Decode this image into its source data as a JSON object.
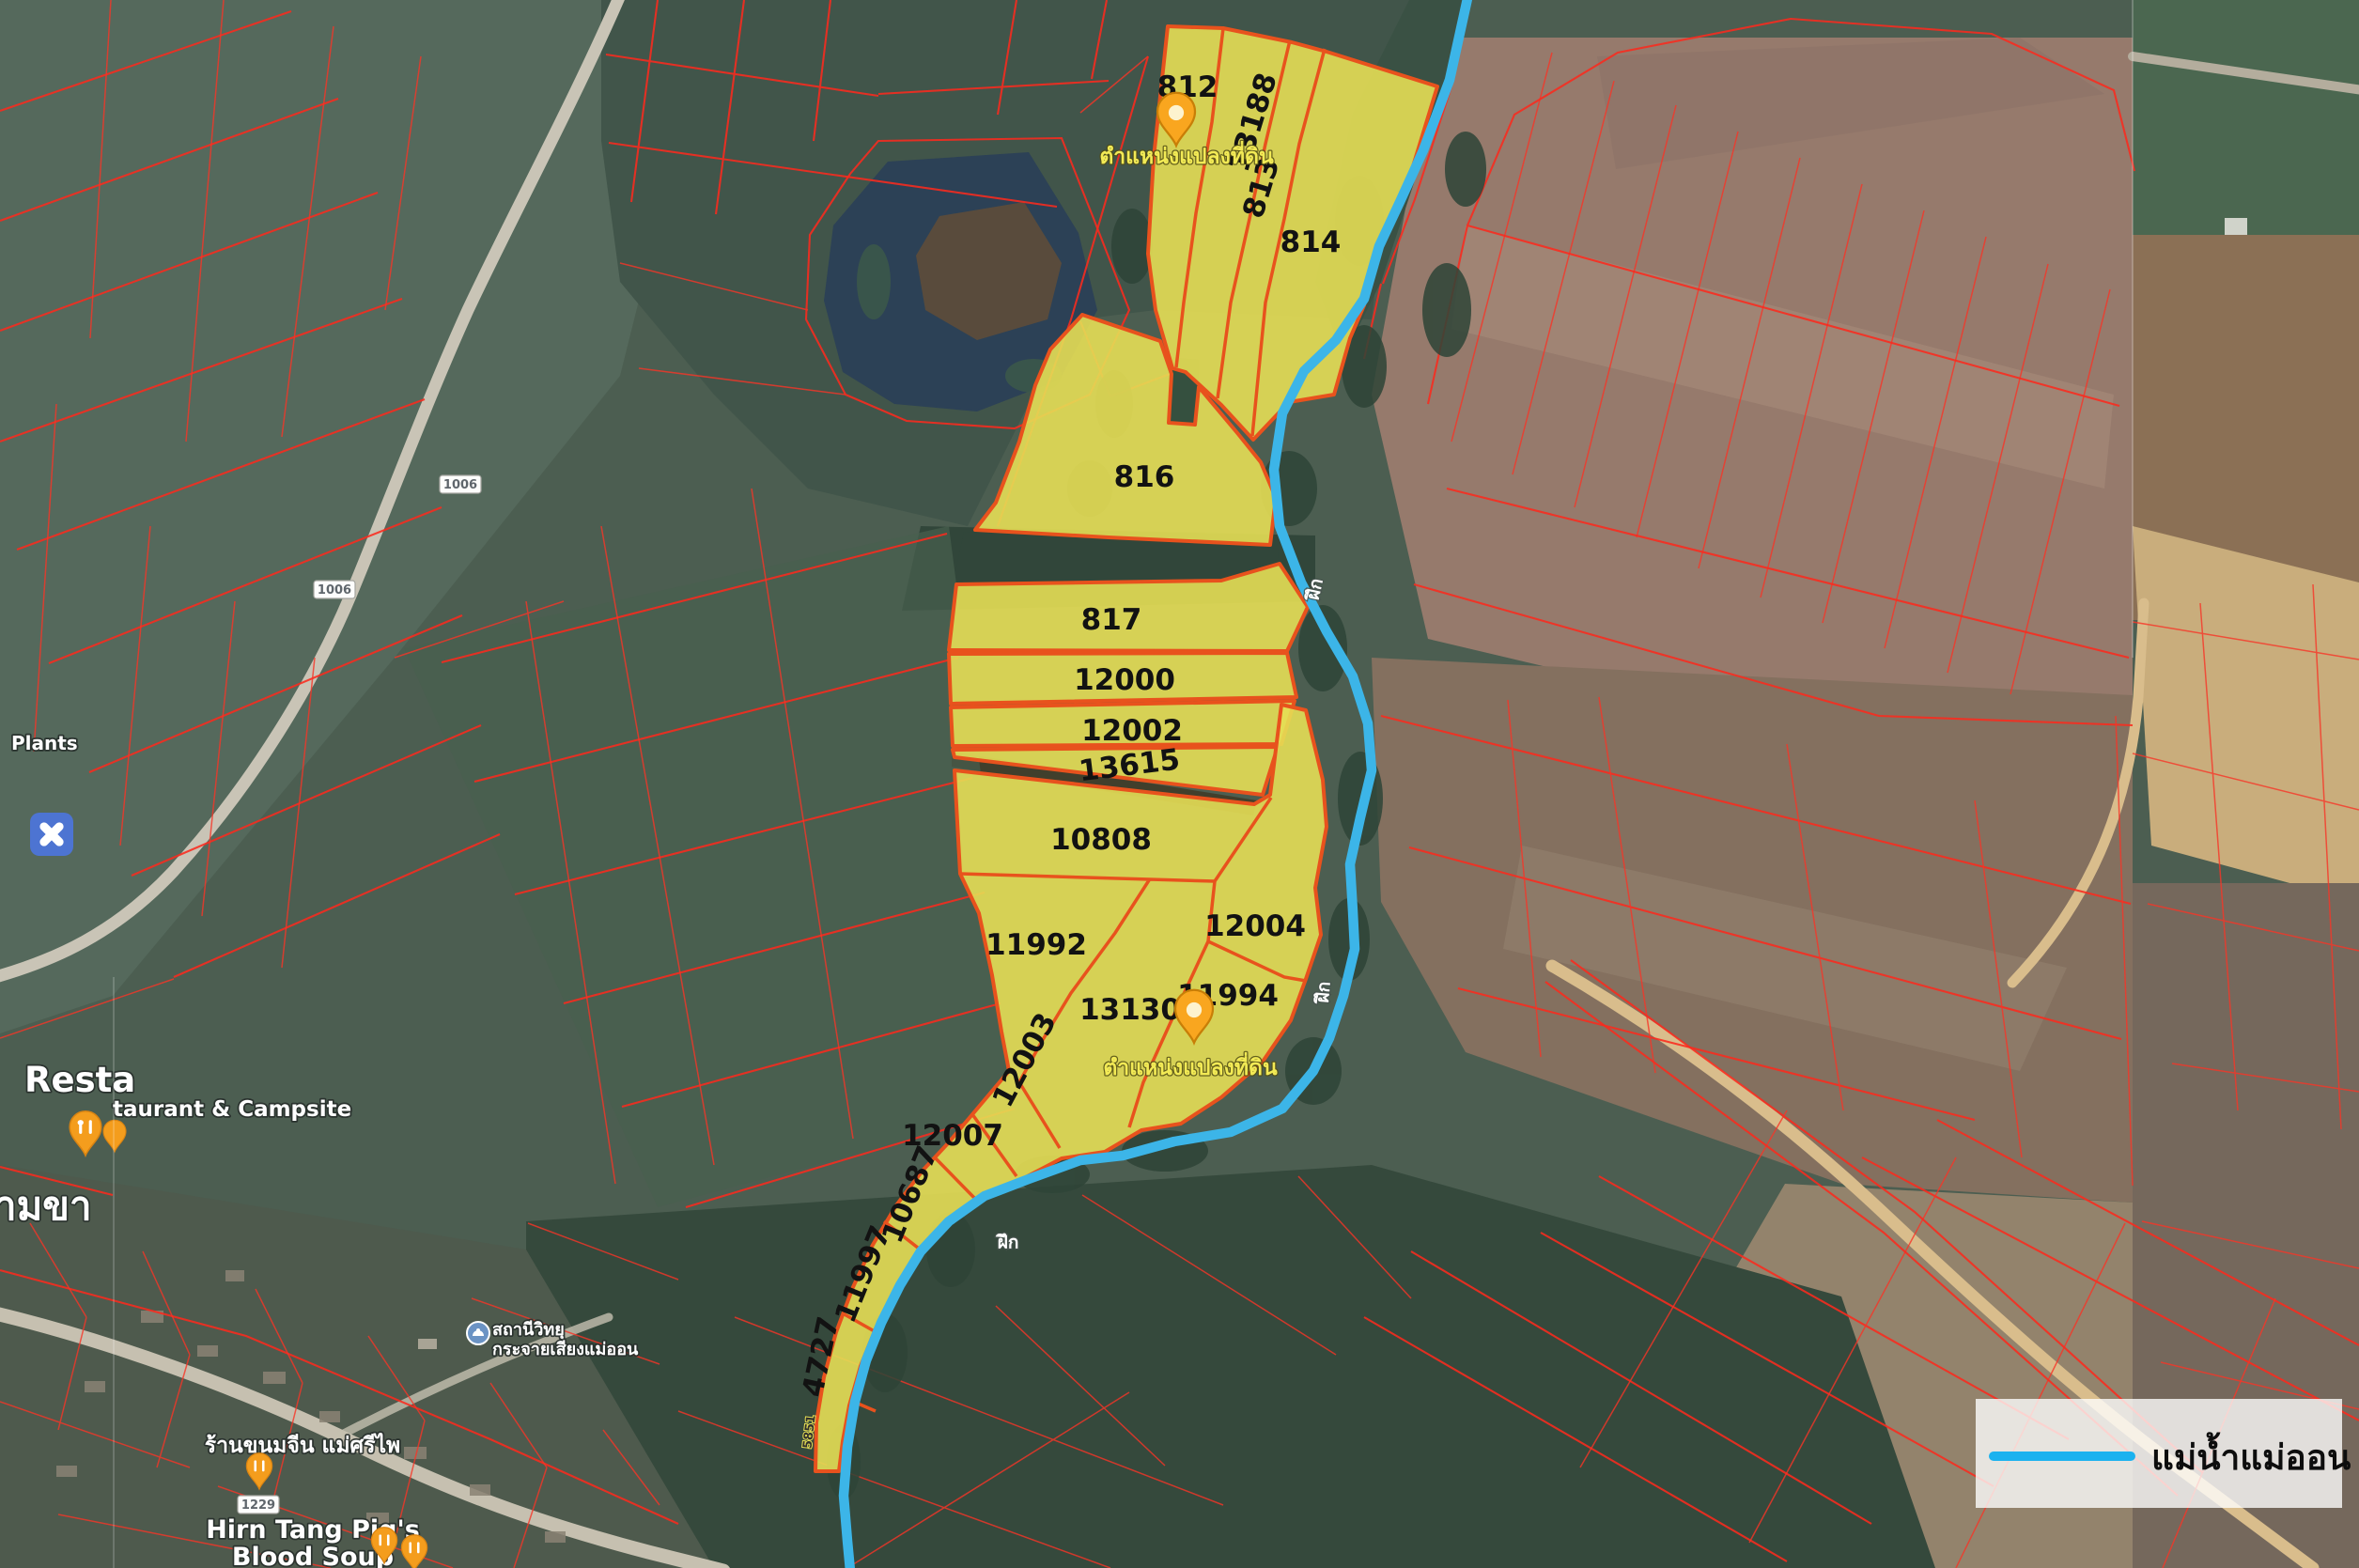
{
  "colors": {
    "river": "#3cb5e8",
    "legend_line": "#1cb2ef",
    "parcel_fill": "#e6de55",
    "parcel_stroke": "#e8521d",
    "cadastral_line": "#fb2a1e"
  },
  "legend": {
    "river_name": "แม่น้ำแม่ออน"
  },
  "pin_label": "ตำแหน่งแปลงที่ดิน",
  "river_label": "ฝึก",
  "parcels": [
    {
      "id": "812"
    },
    {
      "id": "13188"
    },
    {
      "id": "813"
    },
    {
      "id": "814"
    },
    {
      "id": "816"
    },
    {
      "id": "817"
    },
    {
      "id": "12000"
    },
    {
      "id": "12002"
    },
    {
      "id": "13615"
    },
    {
      "id": "10808"
    },
    {
      "id": "11992"
    },
    {
      "id": "12004"
    },
    {
      "id": "13130"
    },
    {
      "id": "11994"
    },
    {
      "id": "12003"
    },
    {
      "id": "12007"
    },
    {
      "id": "10687"
    },
    {
      "id": "11997"
    },
    {
      "id": "4727"
    }
  ],
  "roads": {
    "badge_1006a": "1006",
    "badge_1006b": "1006",
    "badge_1229": "1229",
    "small_5851": "5851"
  },
  "pois": {
    "plants": "Plants",
    "resta_fragment": "Resta",
    "restaurant_campsite": "taurant & Campsite",
    "village_fragment": "ามขา",
    "noodle_shop": "ร้านขนมจีน แม่ศรีไพ",
    "pig_soup_1": "Hirn Tang Pig's",
    "pig_soup_2": "Blood Soup",
    "radio_1": "สถานีวิทยุ",
    "radio_2": "กระจายเสียงแม่ออน"
  }
}
